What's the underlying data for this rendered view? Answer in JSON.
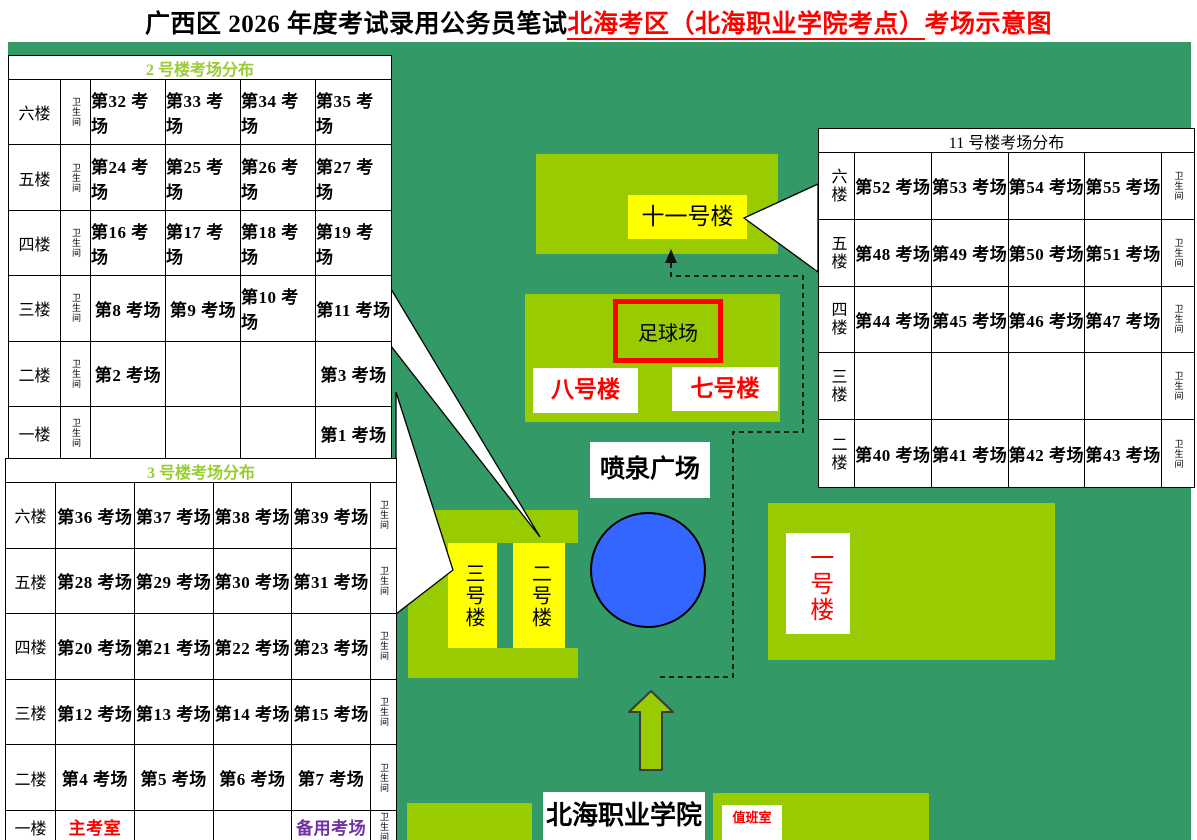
{
  "title": {
    "prefix": "广西区 2026 年度考试录用公务员笔试",
    "location": "北海考区（北海职业学院考点）",
    "suffix": "考场示意图"
  },
  "colors": {
    "map_green": "#339966",
    "block_green": "#99CC00",
    "highlight_yellow": "#FFFF00",
    "fountain_blue": "#3366FF",
    "red_text": "#FF0000",
    "purple_text": "#7030A0",
    "table_header_green": "#99CC33"
  },
  "tables": {
    "building2": {
      "header": "2 号楼考场分布",
      "toilet_label": "卫生间",
      "rows": [
        {
          "floor": "六楼",
          "rooms": [
            "第32 考场",
            "第33 考场",
            "第34 考场",
            "第35 考场"
          ]
        },
        {
          "floor": "五楼",
          "rooms": [
            "第24 考场",
            "第25 考场",
            "第26 考场",
            "第27 考场"
          ]
        },
        {
          "floor": "四楼",
          "rooms": [
            "第16 考场",
            "第17 考场",
            "第18 考场",
            "第19 考场"
          ]
        },
        {
          "floor": "三楼",
          "rooms": [
            "第8 考场",
            "第9 考场",
            "第10 考场",
            "第11 考场"
          ]
        },
        {
          "floor": "二楼",
          "rooms": [
            "第2 考场",
            "",
            "",
            "第3 考场"
          ]
        },
        {
          "floor": "一楼",
          "rooms": [
            "",
            "",
            "",
            "第1 考场"
          ]
        }
      ]
    },
    "building3": {
      "header": "3 号楼考场分布",
      "toilet_label": "卫生间",
      "rows": [
        {
          "floor": "六楼",
          "rooms": [
            "第36 考场",
            "第37 考场",
            "第38 考场",
            "第39 考场"
          ]
        },
        {
          "floor": "五楼",
          "rooms": [
            "第28 考场",
            "第29 考场",
            "第30 考场",
            "第31 考场"
          ]
        },
        {
          "floor": "四楼",
          "rooms": [
            "第20 考场",
            "第21 考场",
            "第22 考场",
            "第23 考场"
          ]
        },
        {
          "floor": "三楼",
          "rooms": [
            "第12 考场",
            "第13 考场",
            "第14 考场",
            "第15 考场"
          ]
        },
        {
          "floor": "二楼",
          "rooms": [
            "第4 考场",
            "第5 考场",
            "第6 考场",
            "第7 考场"
          ]
        },
        {
          "floor": "一楼",
          "rooms": [
            {
              "text": "主考室",
              "style": "red"
            },
            "",
            "",
            {
              "text": "备用考场",
              "style": "purple"
            }
          ]
        }
      ]
    },
    "building11": {
      "header": "11 号楼考场分布",
      "toilet_label": "卫生间",
      "rows": [
        {
          "floor": "六楼",
          "rooms": [
            "第52 考场",
            "第53 考场",
            "第54 考场",
            "第55 考场"
          ]
        },
        {
          "floor": "五楼",
          "rooms": [
            "第48 考场",
            "第49 考场",
            "第50 考场",
            "第51 考场"
          ]
        },
        {
          "floor": "四楼",
          "rooms": [
            "第44 考场",
            "第45 考场",
            "第46 考场",
            "第47 考场"
          ]
        },
        {
          "floor": "三楼",
          "rooms": [
            "",
            "",
            "",
            ""
          ]
        },
        {
          "floor": "二楼",
          "rooms": [
            "第40 考场",
            "第41 考场",
            "第42 考场",
            "第43 考场"
          ]
        }
      ]
    }
  },
  "map": {
    "building11_label": "十一号楼",
    "football_field": "足球场",
    "building8": "八号楼",
    "building7": "七号楼",
    "fountain_plaza": "喷泉广场",
    "building3_tower": "三号楼",
    "building2_tower": "二号楼",
    "building1_label": "一号楼",
    "college_name": "北海职业学院",
    "duty_room": "值班室"
  }
}
